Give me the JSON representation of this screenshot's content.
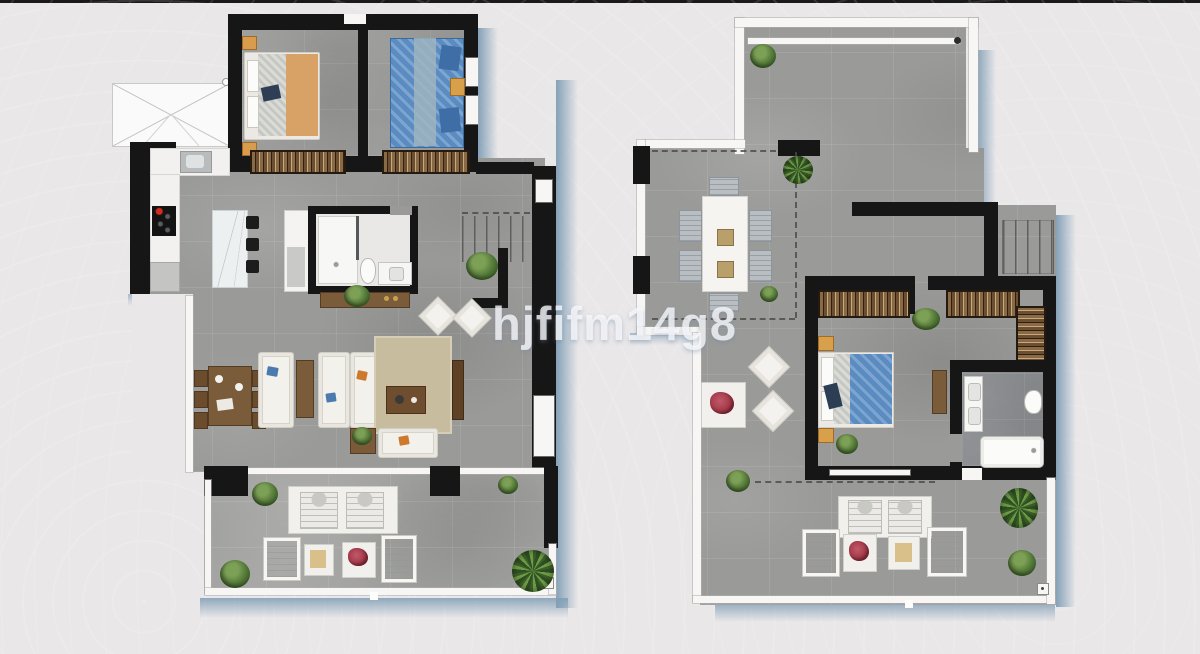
{
  "watermark": {
    "text": "hjfifm14g8"
  },
  "image": {
    "type": "real-estate-floor-plan",
    "views": [
      "lower-floor-plan",
      "upper-floor-plan"
    ]
  },
  "colors": {
    "background": "#e9e7e8",
    "top_bar": "#1a1a1a",
    "wall": "#161616",
    "white_wall": "#f7f6f4",
    "floor_tile": "#9a9b99",
    "bathroom_floor": "#8b8e91",
    "shadow": "#7f9db5",
    "bed_orange": "#d8a266",
    "bed_blue": "#5a8cc2",
    "wood_brown": "#7a5c3a",
    "wardrobe_brown": "#4a3824",
    "rug_tan": "#c8bc9e",
    "plant_green": "#4e7334",
    "flower_red": "#9c2f3e",
    "cooktop_red": "#d22b1f",
    "marble": "#edf0f1"
  }
}
